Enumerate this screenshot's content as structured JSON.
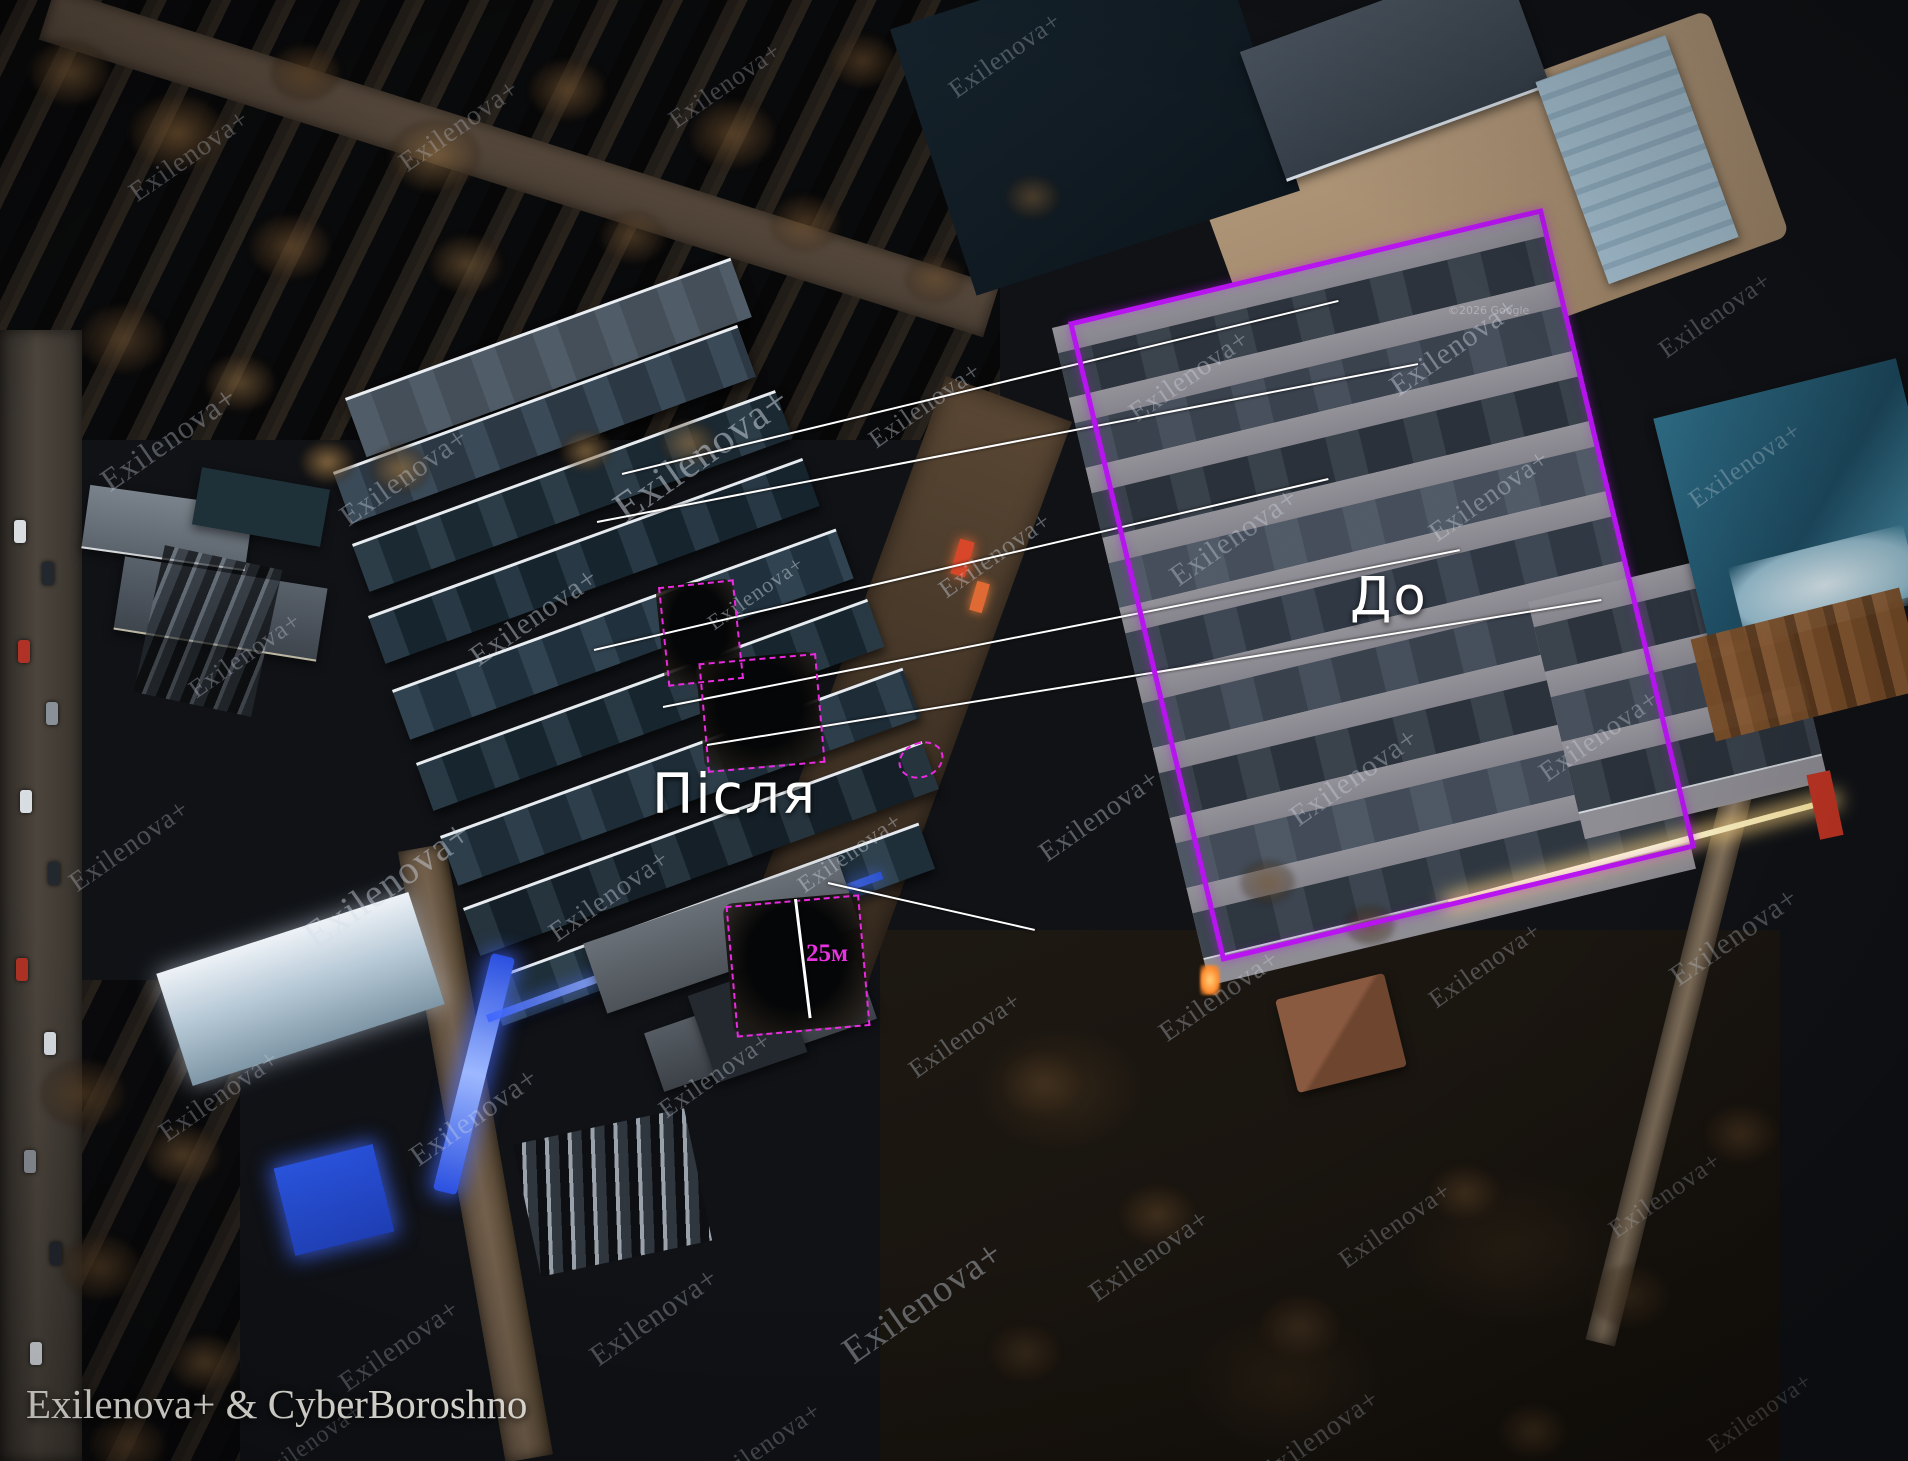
{
  "labels": {
    "after": "Після",
    "before": "До",
    "measurement": "25м"
  },
  "watermark": {
    "text": "Exilenova+"
  },
  "credit": {
    "text": "Exilenova+ & CyberBoroshno"
  },
  "imagery_credit": {
    "text": "©2026 Google"
  },
  "colors": {
    "annotation_rect": "#b714ef",
    "dashed_marker": "#ea2ae0",
    "connector_line": "#ffffff",
    "measurement_text": "#e832e0",
    "label_text": "#ffffff"
  }
}
